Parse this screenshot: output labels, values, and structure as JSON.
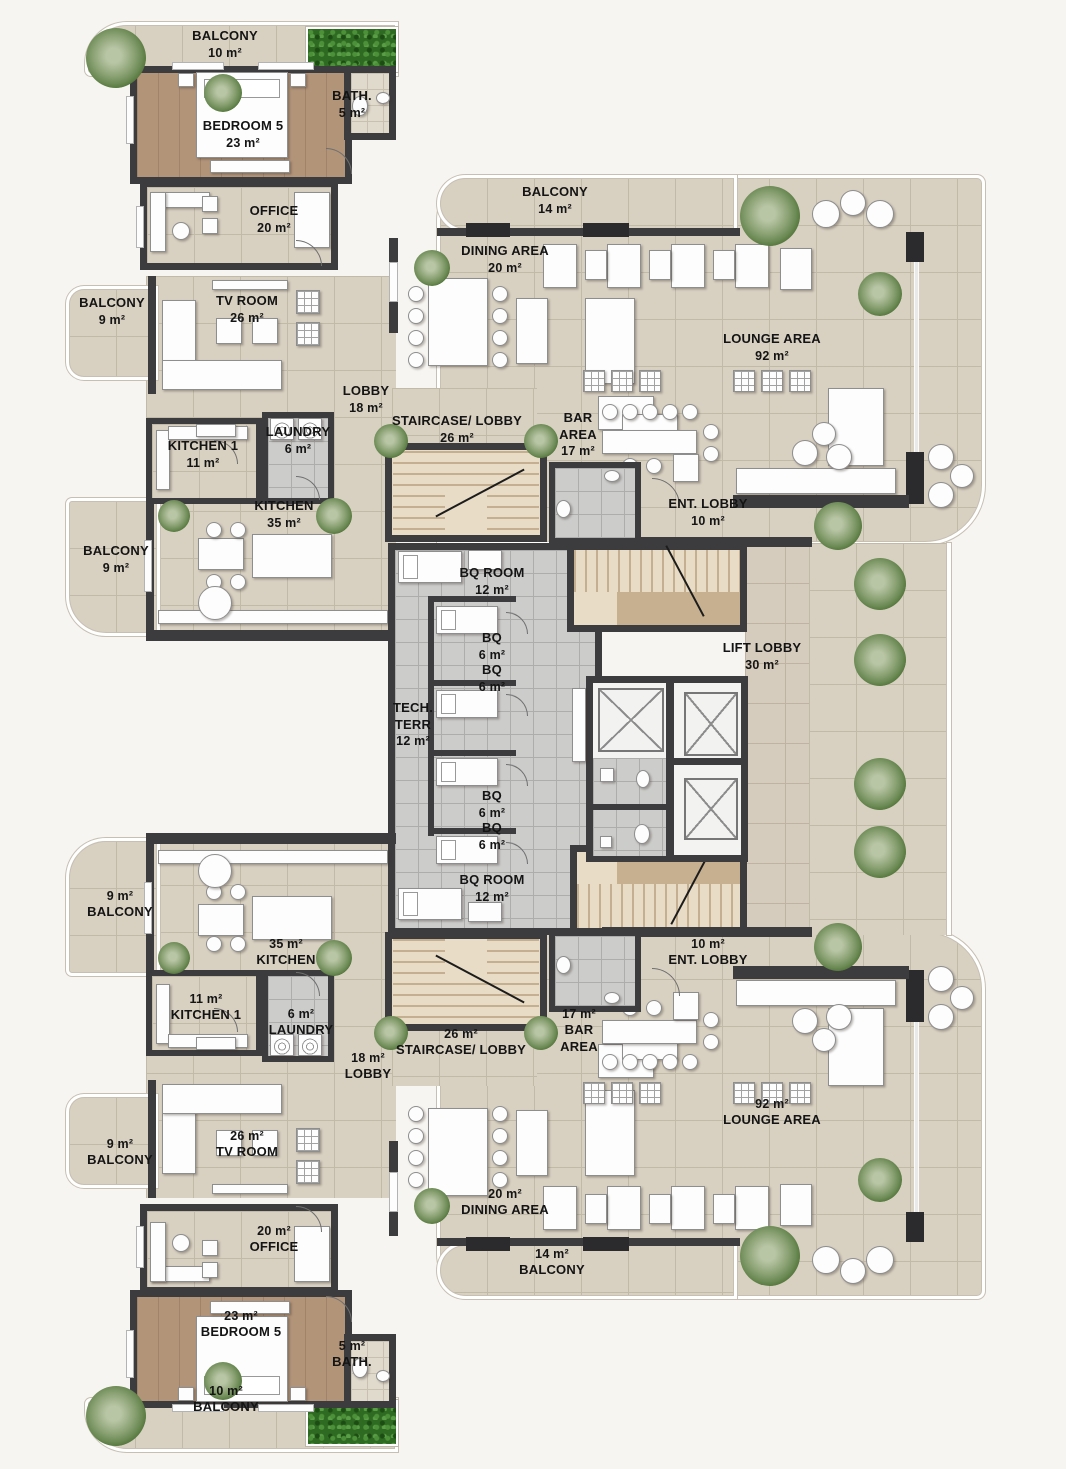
{
  "plan_title": "penthouse-floor-plan",
  "palette": {
    "wall": "#3c3c3e",
    "tile_beige": "#d8d1c2",
    "tile_gray": "#cccccb",
    "tile_tan": "#d6ccbd",
    "wood": "#b29479",
    "stair": "#e8dcc6",
    "hedge_green": "#2e6a21",
    "plant_green": "#8ba274",
    "rail_white": "#ffffff"
  },
  "rooms": {
    "balcony10_t": {
      "name": "BALCONY",
      "area": "10 m²"
    },
    "bedroom5_t": {
      "name": "BEDROOM 5",
      "area": "23 m²"
    },
    "bath_t": {
      "name": "BATH.",
      "area": "5 m²"
    },
    "office_t": {
      "name": "OFFICE",
      "area": "20 m²"
    },
    "balcony9a_t": {
      "name": "BALCONY",
      "area": "9 m²"
    },
    "tvroom_t": {
      "name": "TV ROOM",
      "area": "26 m²"
    },
    "lobby_t": {
      "name": "LOBBY",
      "area": "18 m²"
    },
    "staircase_t": {
      "name": "STAIRCASE/ LOBBY",
      "area": "26 m²"
    },
    "kitchen1_t": {
      "name": "KITCHEN 1",
      "area": "11 m²"
    },
    "laundry_t": {
      "name": "LAUNDRY",
      "area": "6 m²"
    },
    "kitchen_t": {
      "name": "KITCHEN",
      "area": "35 m²"
    },
    "balcony9b_t": {
      "name": "BALCONY",
      "area": "9 m²"
    },
    "balcony14_t": {
      "name": "BALCONY",
      "area": "14 m²"
    },
    "dining_t": {
      "name": "DINING AREA",
      "area": "20 m²"
    },
    "lounge_t": {
      "name": "LOUNGE AREA",
      "area": "92 m²"
    },
    "bar_t": {
      "name": "BAR AREA",
      "area": "17 m²"
    },
    "entlobby_t": {
      "name": "ENT. LOBBY",
      "area": "10 m²"
    },
    "bqroom_t": {
      "name": "BQ ROOM",
      "area": "12 m²"
    },
    "bq1": {
      "name": "BQ",
      "area": "6 m²"
    },
    "bq2": {
      "name": "BQ",
      "area": "6 m²"
    },
    "techterr": {
      "name": "TECH. TERR",
      "area": "12 m²"
    },
    "liftlobby": {
      "name": "LIFT LOBBY",
      "area": "30 m²"
    },
    "bq3": {
      "name": "BQ",
      "area": "6 m²"
    },
    "bq4": {
      "name": "BQ",
      "area": "6 m²"
    },
    "bqroom_b": {
      "name": "BQ ROOM",
      "area": "12 m²"
    },
    "balcony9k_b": {
      "name": "BALCONY",
      "area": "9 m²"
    },
    "kitchen_b": {
      "name": "KITCHEN",
      "area": "35 m²"
    },
    "kitchen1_b": {
      "name": "KITCHEN 1",
      "area": "11 m²"
    },
    "laundry_b": {
      "name": "LAUNDRY",
      "area": "6 m²"
    },
    "lobby_b": {
      "name": "LOBBY",
      "area": "18 m²"
    },
    "staircase_b": {
      "name": "STAIRCASE/ LOBBY",
      "area": "26 m²"
    },
    "bar_b": {
      "name": "BAR AREA",
      "area": "17 m²"
    },
    "entlobby_b": {
      "name": "ENT. LOBBY",
      "area": "10 m²"
    },
    "balcony9t_b": {
      "name": "BALCONY",
      "area": "9 m²"
    },
    "tvroom_b": {
      "name": "TV ROOM",
      "area": "26 m²"
    },
    "office_b": {
      "name": "OFFICE",
      "area": "20 m²"
    },
    "bedroom5_b": {
      "name": "BEDROOM 5",
      "area": "23 m²"
    },
    "bath_b": {
      "name": "BATH.",
      "area": "5 m²"
    },
    "lounge_b": {
      "name": "LOUNGE AREA",
      "area": "92 m²"
    },
    "dining_b": {
      "name": "DINING AREA",
      "area": "20 m²"
    },
    "balcony14_b": {
      "name": "BALCONY",
      "area": "14 m²"
    },
    "balcony10_b": {
      "name": "BALCONY",
      "area": "10 m²"
    }
  }
}
